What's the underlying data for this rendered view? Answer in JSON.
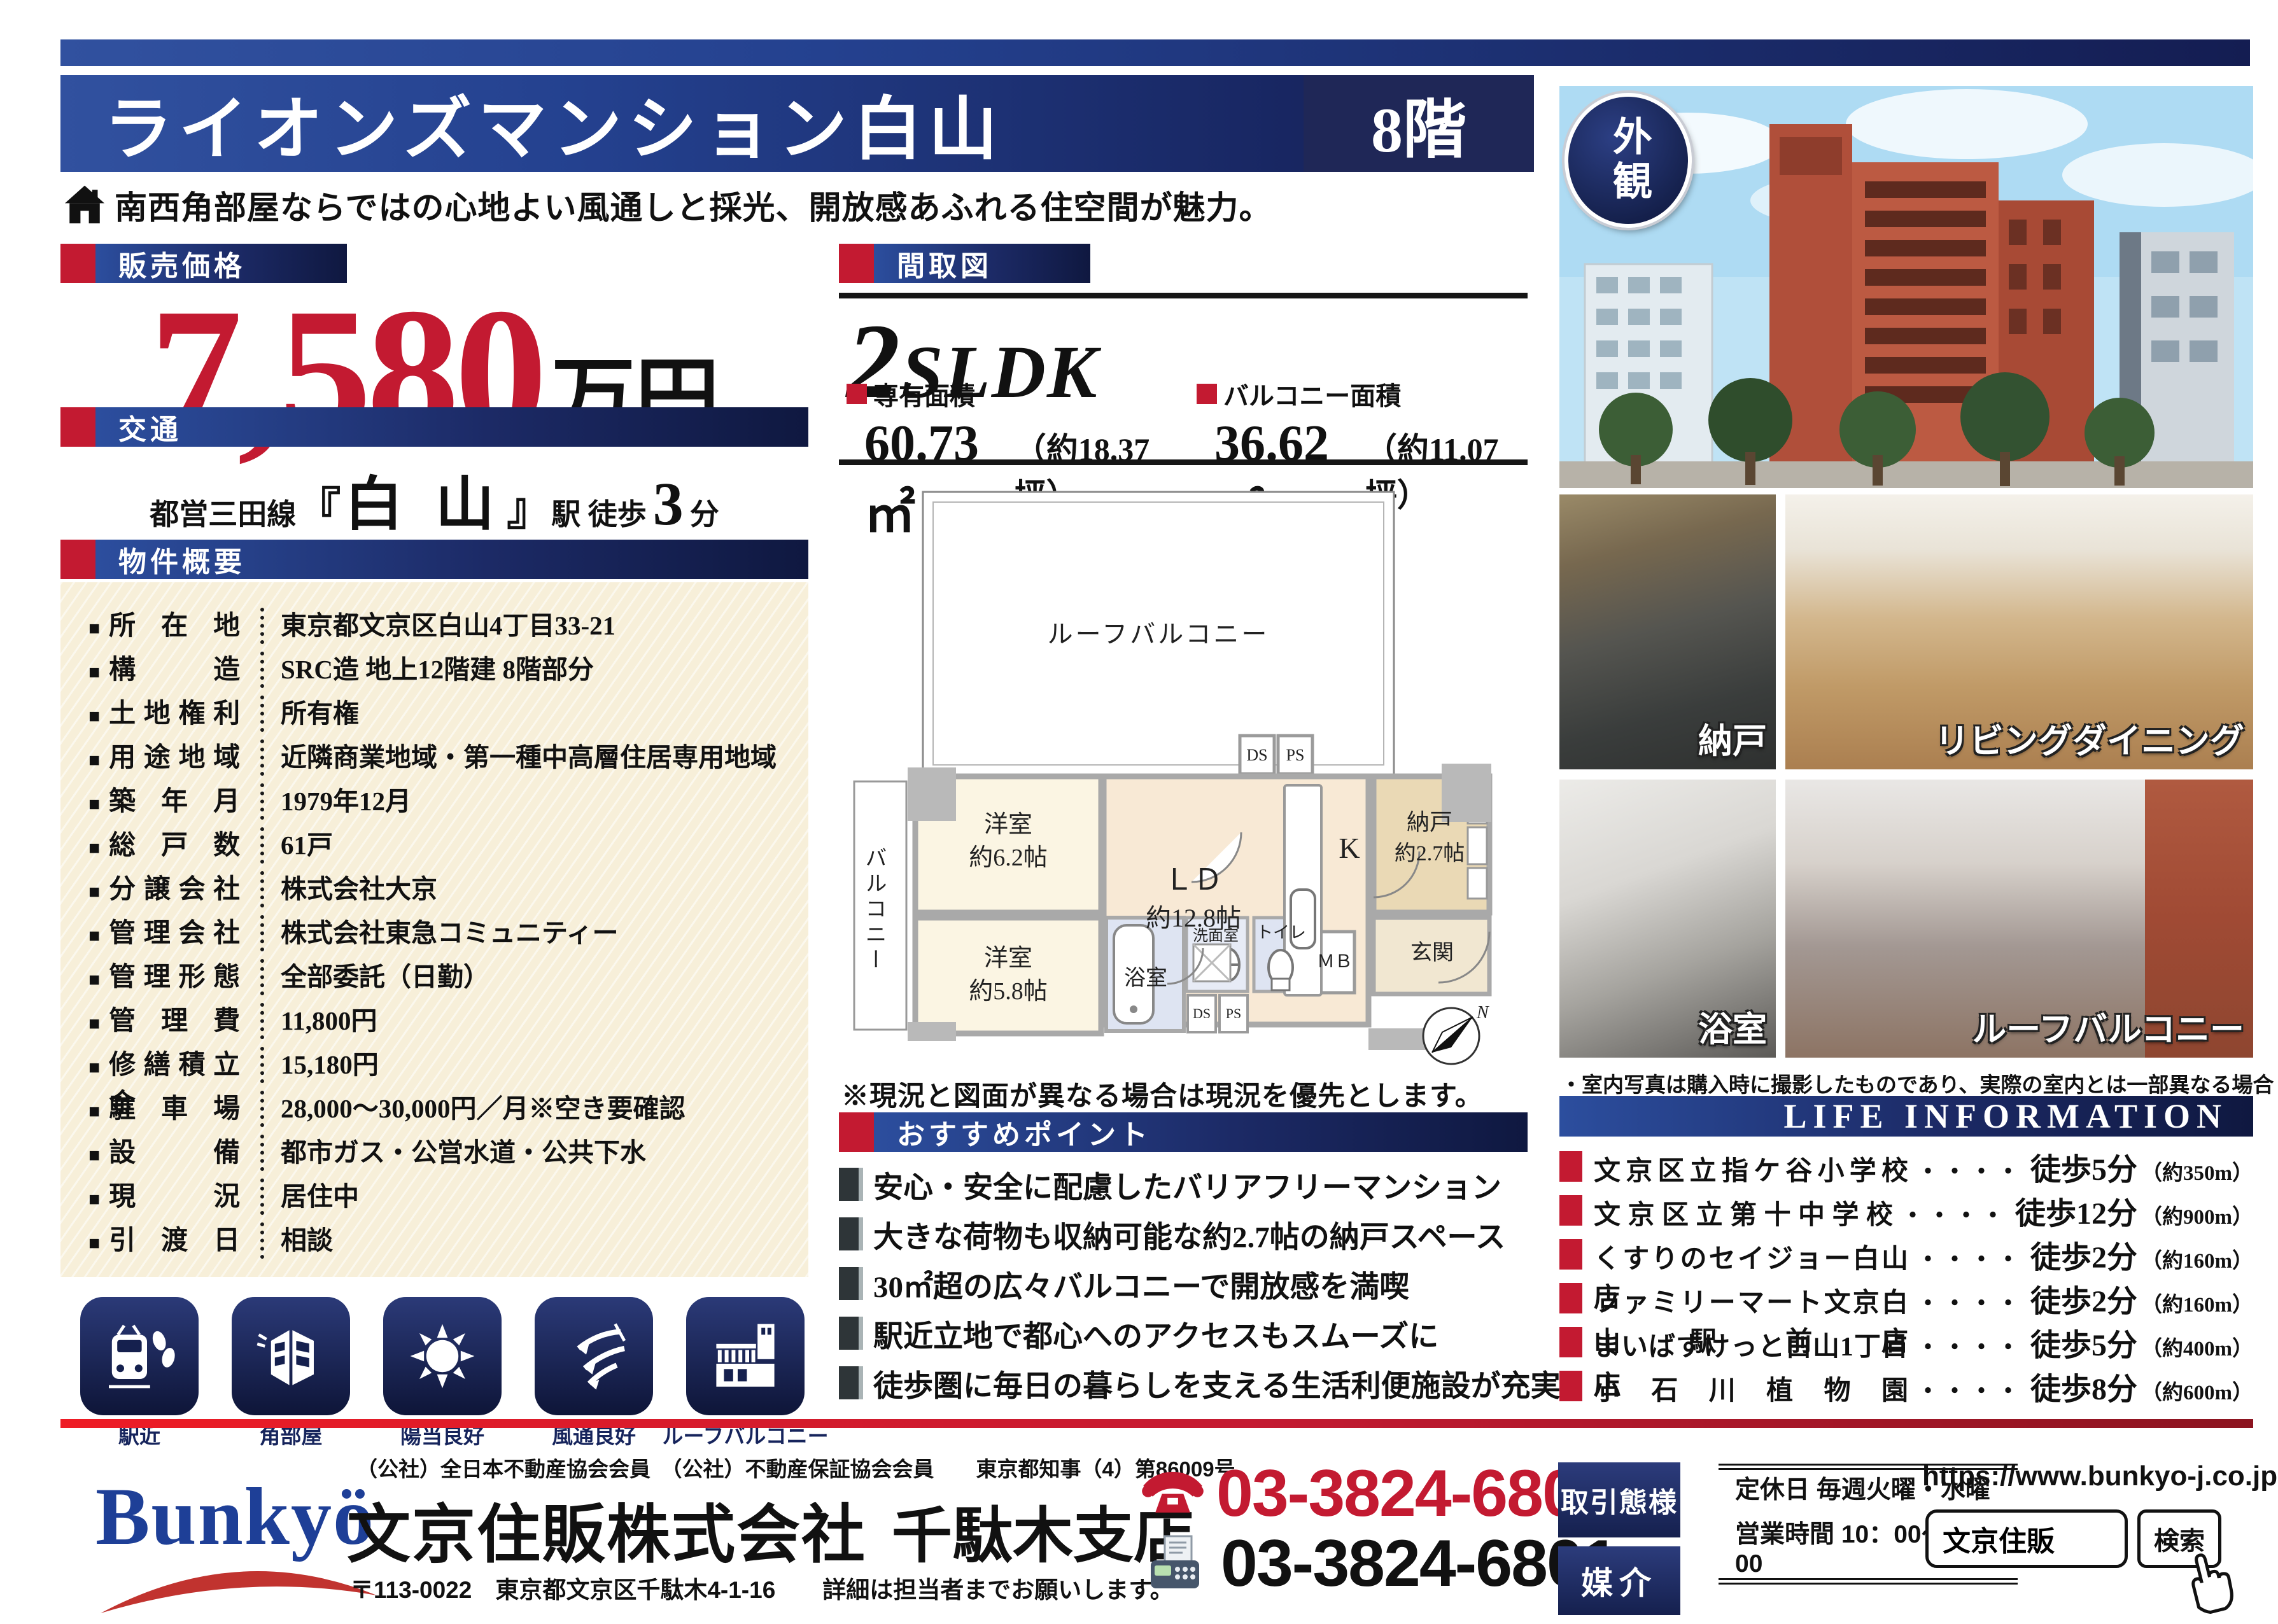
{
  "header": {
    "title": "ライオンズマンション白山",
    "floor": "8階",
    "subtitle": "南西角部屋ならではの心地よい風通しと採光、開放感あふれる住空間が魅力。"
  },
  "price": {
    "label": "販売価格",
    "value": "7,580",
    "unit": "万円"
  },
  "transport": {
    "label": "交通",
    "line": "都営三田線",
    "bracket_open": "『",
    "station": "白 山",
    "bracket_close": "』",
    "walk": "駅 徒歩",
    "minutes": "3",
    "minutes_unit": "分"
  },
  "overview": {
    "label": "物件概要",
    "rows": [
      {
        "k": "所在地",
        "v": "東京都文京区白山4丁目33-21"
      },
      {
        "k": "構造",
        "v": "SRC造 地上12階建 8階部分"
      },
      {
        "k": "土地権利",
        "v": "所有権"
      },
      {
        "k": "用途地域",
        "v": "近隣商業地域・第一種中高層住居専用地域"
      },
      {
        "k": "築年月",
        "v": "1979年12月"
      },
      {
        "k": "総戸数",
        "v": "61戸"
      },
      {
        "k": "分譲会社",
        "v": "株式会社大京"
      },
      {
        "k": "管理会社",
        "v": "株式会社東急コミュニティー"
      },
      {
        "k": "管理形態",
        "v": "全部委託（日勤）"
      },
      {
        "k": "管理費",
        "v": "11,800円"
      },
      {
        "k": "修繕積立金",
        "v": "15,180円"
      },
      {
        "k": "駐車場",
        "v": "28,000〜30,000円／月※空き要確認"
      },
      {
        "k": "設備",
        "v": "都市ガス・公営水道・公共下水"
      },
      {
        "k": "現況",
        "v": "居住中"
      },
      {
        "k": "引渡日",
        "v": "相談"
      }
    ]
  },
  "features": [
    "駅近",
    "角部屋",
    "陽当良好",
    "風通良好",
    "ルーフバルコニー"
  ],
  "madori": {
    "label": "間取図",
    "layout_num": "2",
    "layout_type": "SLDK",
    "area1_label": "専有面積",
    "area1_value": "60.73㎡",
    "area1_tsubo": "（約18.37坪）",
    "area2_label": "バルコニー面積",
    "area2_value": "36.62㎡",
    "area2_tsubo": "（約11.07坪）",
    "note": "※現況と図面が異なる場合は現況を優先とします。"
  },
  "floorplan": {
    "roof_balcony": "ルーフバルコニー",
    "balcony": "バルコニー",
    "room1": "洋室",
    "room1_size": "約6.2帖",
    "ld": "ＬＤ",
    "ld_size": "約12.8帖",
    "kitchen": "K",
    "storage": "納戸",
    "storage_size": "約2.7帖",
    "room2": "洋室",
    "room2_size": "約5.8帖",
    "bath": "浴室",
    "wash": "洗面室",
    "toilet": "トイレ",
    "mb": "ＭＢ",
    "entrance": "玄関",
    "ds": "DS",
    "ps": "PS",
    "north": "N"
  },
  "points": {
    "label": "おすすめポイント",
    "items": [
      "安心・安全に配慮したバリアフリーマンション",
      "大きな荷物も収納可能な約2.7帖の納戸スペース",
      "30㎡超の広々バルコニーで開放感を満喫",
      "駅近立地で都心へのアクセスもスムーズに",
      "徒歩圏に毎日の暮らしを支える生活利便施設が充実"
    ]
  },
  "photos": {
    "badge": "外観",
    "labels": [
      "納戸",
      "リビングダイニング",
      "浴室",
      "ルーフバルコニー"
    ],
    "note": "・室内写真は購入時に撮影したものであり、実際の室内とは一部異なる場合がございます。"
  },
  "life": {
    "title": "LIFE INFORMATION",
    "items": [
      {
        "name": "文京区立指ケ谷小学校",
        "dots": "・・・・",
        "walk": "徒歩5分",
        "dist": "（約350m）"
      },
      {
        "name": "文京区立第十中学校",
        "dots": "・・・・",
        "walk": "徒歩12分",
        "dist": "（約900m）"
      },
      {
        "name": "くすりのセイジョー白山店",
        "dots": "・・・・",
        "walk": "徒歩2分",
        "dist": "（約160m）"
      },
      {
        "name": "ファミリーマート文京白山駅前店",
        "dots": "・・・・",
        "walk": "徒歩2分",
        "dist": "（約160m）"
      },
      {
        "name": "まいばすけっと白山1丁目店",
        "dots": "・・・・",
        "walk": "徒歩5分",
        "dist": "（約400m）"
      },
      {
        "name": "小石川植物園",
        "dots": "・・・・",
        "walk": "徒歩8分",
        "dist": "（約600m）"
      }
    ]
  },
  "footer": {
    "memberships": "（公社）全日本不動産協会会員　（公社）不動産保証協会会員　　東京都知事（4）第86009号",
    "logo": "Bunkyö",
    "company": "文京住販株式会社",
    "branch": "千駄木支店",
    "address": "〒113-0022　東京都文京区千駄木4-1-16　　詳細は担当者までお願いします。",
    "tel": "03-3824-6800",
    "fax": "03-3824-6801",
    "deal_label": "取引態様",
    "deal_type": "媒介",
    "holiday": "定休日  毎週火曜・水曜",
    "hours": "営業時間  10：00〜19：00",
    "url": "https://www.bunkyo-j.co.jp",
    "search_value": "文京住販",
    "search_button": "検索"
  }
}
